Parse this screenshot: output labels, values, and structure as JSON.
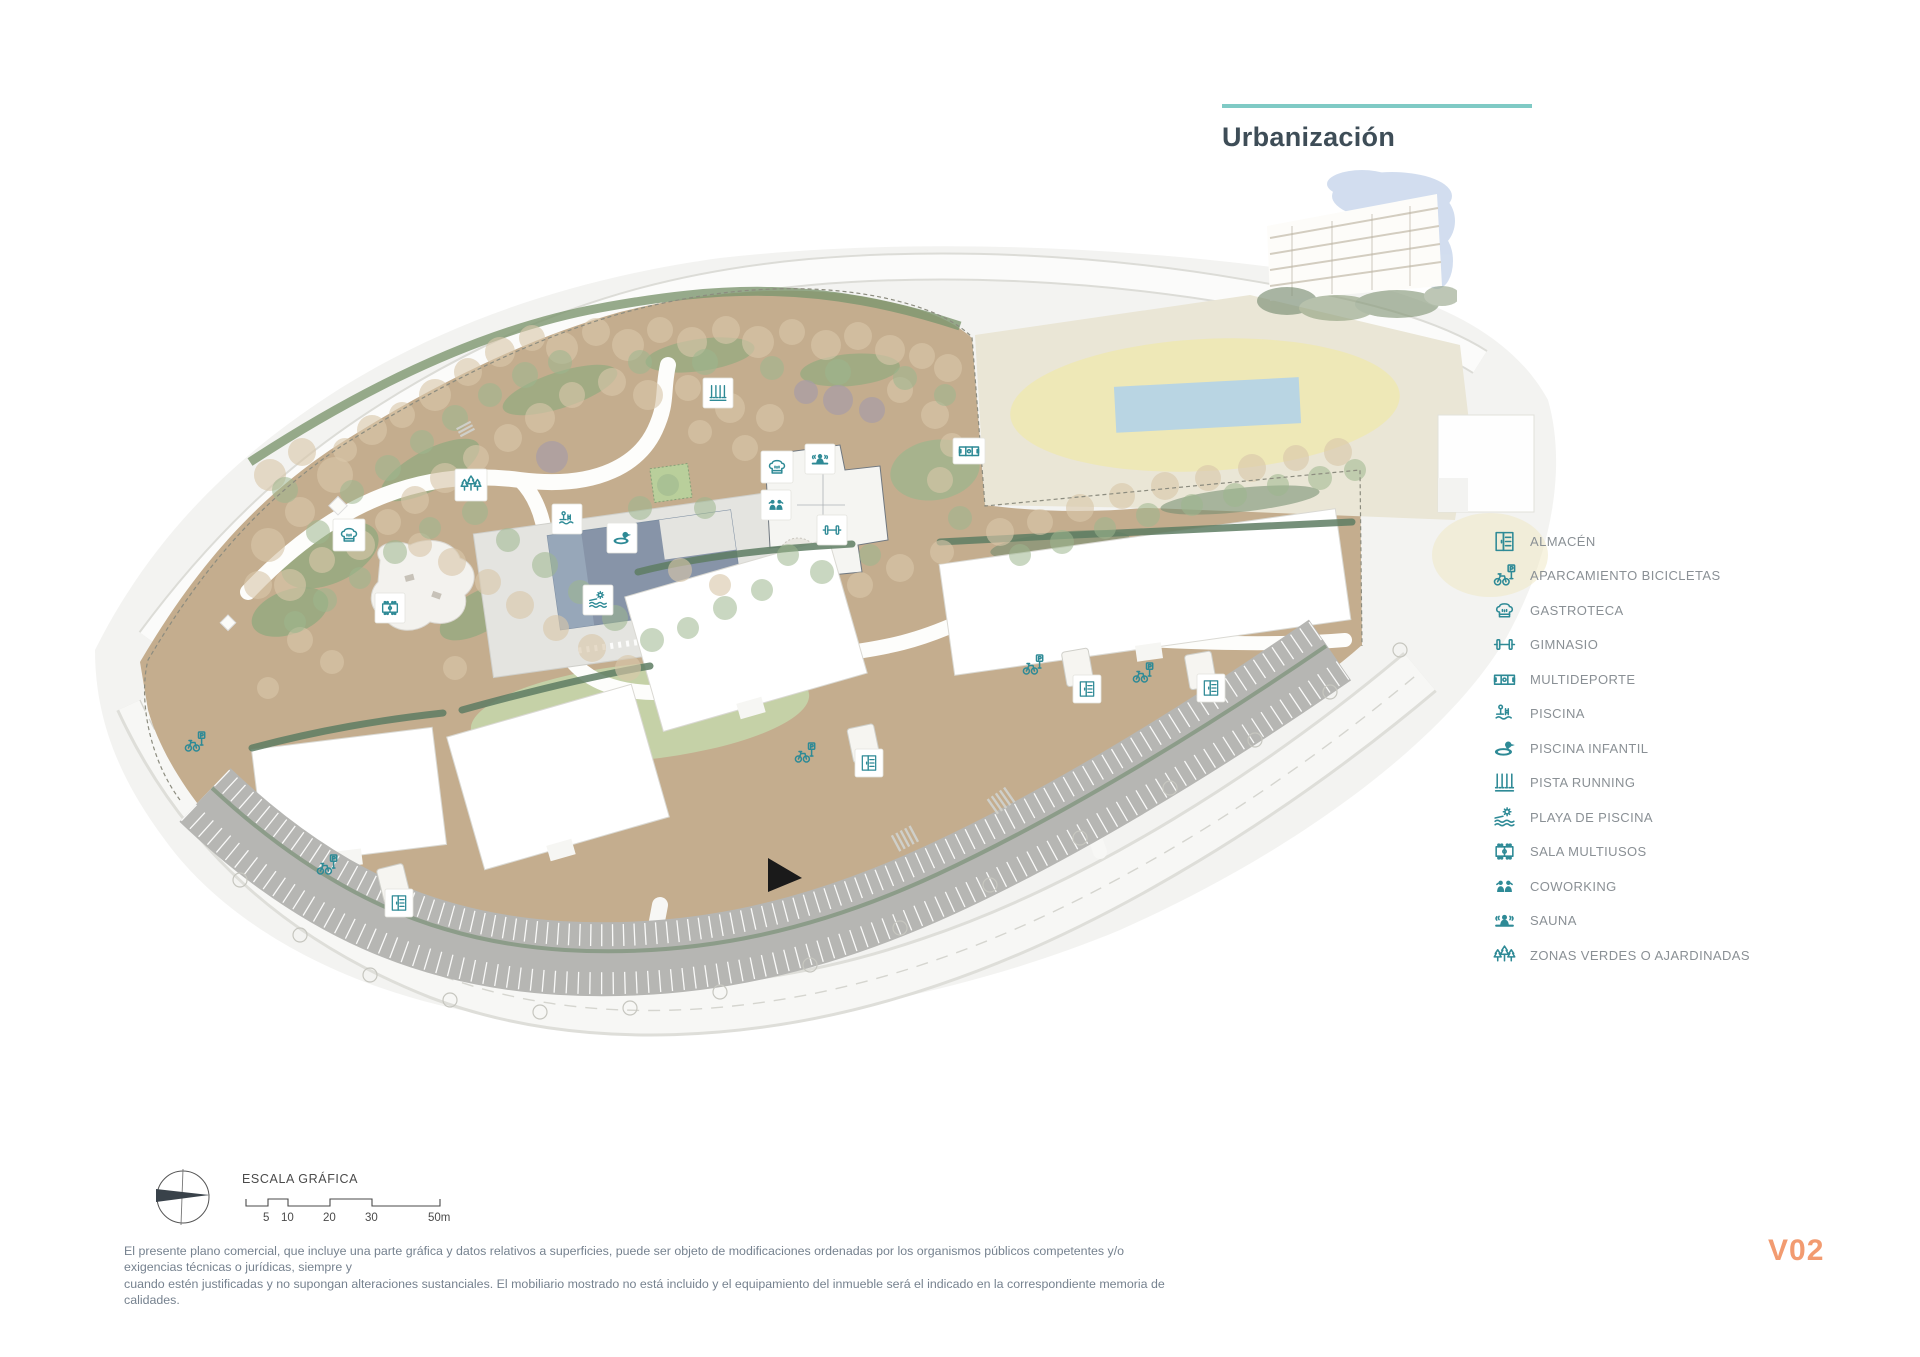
{
  "panel": {
    "title": "Urbanización",
    "legend": {
      "items": [
        {
          "label": "ALMACÉN",
          "icon": "storage-cabinet-icon"
        },
        {
          "label": "APARCAMIENTO BICICLETAS",
          "icon": "bicycle-parking-icon"
        },
        {
          "label": "GASTROTECA",
          "icon": "chef-hat-icon"
        },
        {
          "label": "GIMNASIO",
          "icon": "dumbbell-icon"
        },
        {
          "label": "MULTIDEPORTE",
          "icon": "sports-court-icon"
        },
        {
          "label": "PISCINA",
          "icon": "pool-ladder-icon"
        },
        {
          "label": "PISCINA INFANTIL",
          "icon": "duck-float-icon"
        },
        {
          "label": "PISTA RUNNING",
          "icon": "running-track-icon"
        },
        {
          "label": "PLAYA DE PISCINA",
          "icon": "sun-waves-icon"
        },
        {
          "label": "SALA MULTIUSOS",
          "icon": "multipurpose-room-icon"
        },
        {
          "label": "COWORKING",
          "icon": "coworking-people-icon"
        },
        {
          "label": "SAUNA",
          "icon": "sauna-person-icon"
        },
        {
          "label": "ZONAS VERDES O AJARDINADAS",
          "icon": "trees-icon"
        }
      ]
    }
  },
  "map": {
    "scale": {
      "label": "ESCALA GRÁFICA",
      "ticks": [
        "5",
        "10",
        "20",
        "30",
        "50m"
      ]
    },
    "marker_icons": [
      "chef-hat-icon",
      "multipurpose-room-icon",
      "trees-icon",
      "pool-ladder-icon",
      "duck-float-icon",
      "sun-waves-icon",
      "running-track-icon",
      "sauna-person-icon",
      "coworking-people-icon",
      "dumbbell-icon",
      "sports-court-icon",
      "bicycle-parking-icon",
      "storage-cabinet-icon"
    ]
  },
  "footer": {
    "disclaimer_line1": "El presente plano comercial, que incluye una parte gráfica y datos relativos a superficies, puede ser objeto de modificaciones ordenadas por los organismos públicos competentes y/o exigencias técnicas o jurídicas, siempre y",
    "disclaimer_line2": "cuando estén justificadas y no supongan alteraciones sustanciales. El mobiliario mostrado no está incluido y el equipamiento del inmueble será el indicado en la correspondiente memoria de calidades.",
    "version": "V02"
  },
  "colors": {
    "accent_teal": "#2e8a96",
    "header_line": "#7fcac5",
    "version_orange": "#f29b70",
    "site_tan": "#c4ad8e",
    "pool_water": "#8794a8",
    "context_pool_blue": "#b9d5e3",
    "parking_gray": "#b6b6b3"
  }
}
